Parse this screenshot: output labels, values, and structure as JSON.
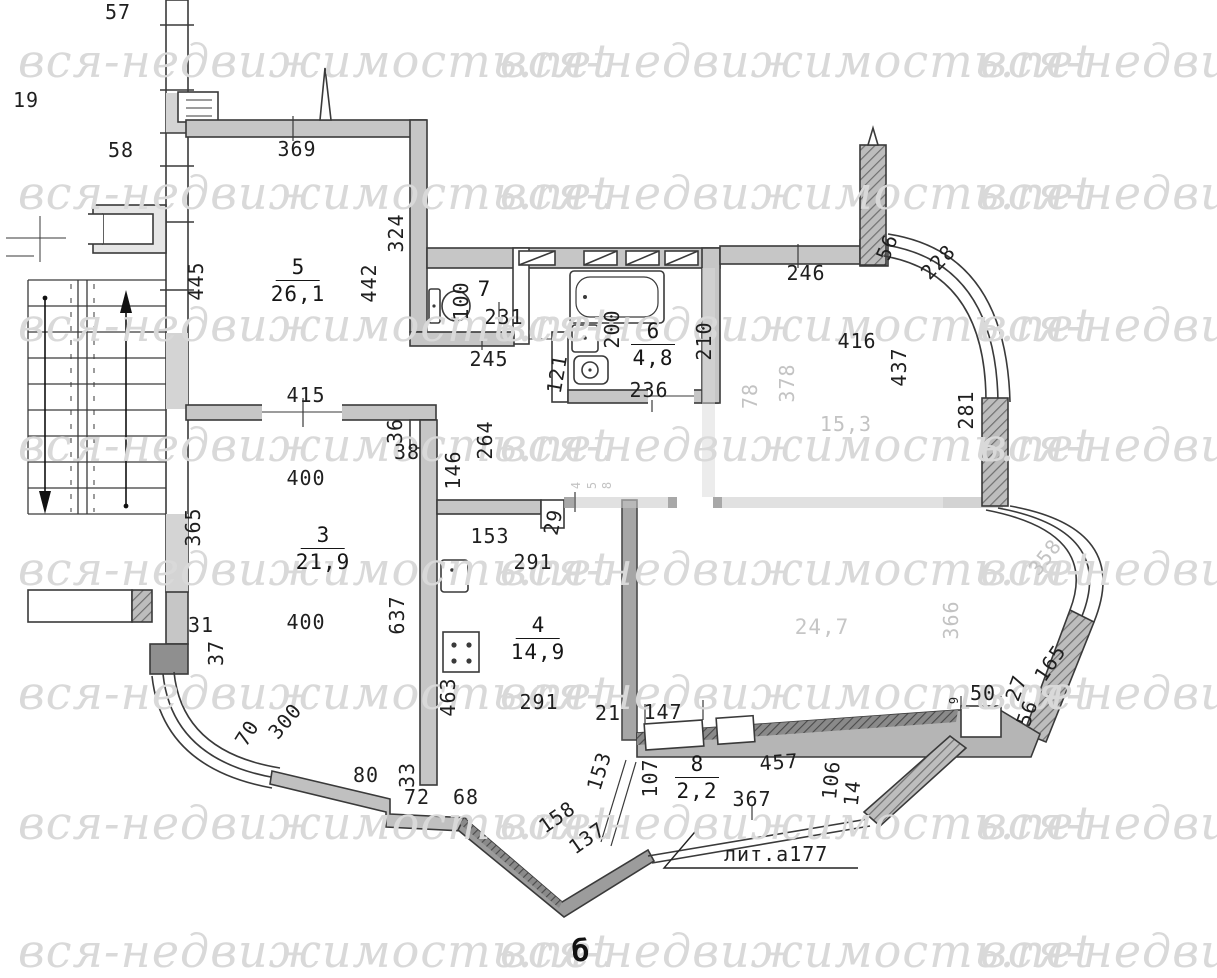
{
  "watermark": {
    "text": "вся-недвижимость.net",
    "color": "#d9d9d9"
  },
  "plan": {
    "litera": {
      "text": "лит.а177"
    },
    "rooms": [
      {
        "number": "5",
        "area": "26,1",
        "x": 298,
        "y": 256
      },
      {
        "number": "7",
        "area": "",
        "x": 484,
        "y": 278
      },
      {
        "number": "6",
        "area": "4,8",
        "x": 653,
        "y": 320
      },
      {
        "number": "3",
        "area": "21,9",
        "x": 323,
        "y": 524
      },
      {
        "number": "4",
        "area": "14,9",
        "x": 538,
        "y": 614
      },
      {
        "number": "8",
        "area": "2,2",
        "x": 697,
        "y": 753
      },
      {
        "number": "",
        "area": "24,7",
        "x": 822,
        "y": 616,
        "faded": true
      }
    ],
    "labels": [
      {
        "t": "57",
        "x": 118,
        "y": 12
      },
      {
        "t": "19",
        "x": 26,
        "y": 100
      },
      {
        "t": "58",
        "x": 121,
        "y": 150
      },
      {
        "t": "369",
        "x": 297,
        "y": 149
      },
      {
        "t": "445",
        "x": 196,
        "y": 281,
        "r": -90
      },
      {
        "t": "324",
        "x": 396,
        "y": 233,
        "r": -90
      },
      {
        "t": "442",
        "x": 369,
        "y": 283,
        "r": -90
      },
      {
        "t": "100",
        "x": 461,
        "y": 301,
        "r": -90
      },
      {
        "t": "231",
        "x": 504,
        "y": 317
      },
      {
        "t": "245",
        "x": 489,
        "y": 359
      },
      {
        "t": "121",
        "x": 557,
        "y": 374,
        "r": -80
      },
      {
        "t": "200",
        "x": 612,
        "y": 329,
        "r": -90
      },
      {
        "t": "236",
        "x": 649,
        "y": 390
      },
      {
        "t": "210",
        "x": 704,
        "y": 341,
        "r": -90
      },
      {
        "t": "246",
        "x": 806,
        "y": 273
      },
      {
        "t": "56",
        "x": 887,
        "y": 247,
        "r": -68
      },
      {
        "t": "228",
        "x": 938,
        "y": 262,
        "r": -46
      },
      {
        "t": "416",
        "x": 857,
        "y": 341
      },
      {
        "t": "437",
        "x": 899,
        "y": 367,
        "r": -90
      },
      {
        "t": "281",
        "x": 966,
        "y": 410,
        "r": -90
      },
      {
        "t": "78",
        "x": 750,
        "y": 396,
        "r": -90,
        "f": 1
      },
      {
        "t": "378",
        "x": 787,
        "y": 383,
        "r": -90,
        "f": 1
      },
      {
        "t": "15,3",
        "x": 846,
        "y": 424,
        "f": 1
      },
      {
        "t": "415",
        "x": 306,
        "y": 395
      },
      {
        "t": "36",
        "x": 395,
        "y": 431,
        "r": -90
      },
      {
        "t": "38",
        "x": 407,
        "y": 452
      },
      {
        "t": "146",
        "x": 453,
        "y": 470,
        "r": -90
      },
      {
        "t": "264",
        "x": 485,
        "y": 440,
        "r": -90
      },
      {
        "t": "400",
        "x": 306,
        "y": 478
      },
      {
        "t": "365",
        "x": 193,
        "y": 527,
        "r": -90
      },
      {
        "t": "400",
        "x": 306,
        "y": 622
      },
      {
        "t": "637",
        "x": 397,
        "y": 615,
        "r": -90
      },
      {
        "t": "153",
        "x": 490,
        "y": 536
      },
      {
        "t": "291",
        "x": 533,
        "y": 562
      },
      {
        "t": "29",
        "x": 553,
        "y": 522,
        "r": -78
      },
      {
        "t": "4",
        "x": 576,
        "y": 485,
        "r": -90,
        "f": 1,
        "s": 1
      },
      {
        "t": "5",
        "x": 592,
        "y": 485,
        "r": -90,
        "f": 1,
        "s": 1
      },
      {
        "t": "8",
        "x": 607,
        "y": 485,
        "r": -90,
        "f": 1,
        "s": 1
      },
      {
        "t": "463",
        "x": 448,
        "y": 697,
        "r": -90
      },
      {
        "t": "291",
        "x": 539,
        "y": 702
      },
      {
        "t": "31",
        "x": 201,
        "y": 625
      },
      {
        "t": "37",
        "x": 216,
        "y": 653,
        "r": -90
      },
      {
        "t": "70",
        "x": 247,
        "y": 733,
        "r": -58
      },
      {
        "t": "300",
        "x": 285,
        "y": 721,
        "r": -50
      },
      {
        "t": "80",
        "x": 366,
        "y": 775
      },
      {
        "t": "33",
        "x": 407,
        "y": 775,
        "r": -90
      },
      {
        "t": "72",
        "x": 417,
        "y": 797
      },
      {
        "t": "68",
        "x": 466,
        "y": 797
      },
      {
        "t": "158",
        "x": 557,
        "y": 817,
        "r": -35
      },
      {
        "t": "137",
        "x": 587,
        "y": 838,
        "r": -35
      },
      {
        "t": "153",
        "x": 599,
        "y": 771,
        "r": -73
      },
      {
        "t": "21",
        "x": 608,
        "y": 713
      },
      {
        "t": "147",
        "x": 663,
        "y": 712
      },
      {
        "t": "107",
        "x": 650,
        "y": 778,
        "r": -90
      },
      {
        "t": "457",
        "x": 779,
        "y": 762,
        "r": -4
      },
      {
        "t": "367",
        "x": 752,
        "y": 799
      },
      {
        "t": "106",
        "x": 831,
        "y": 780,
        "r": -84
      },
      {
        "t": "14",
        "x": 852,
        "y": 793,
        "r": -84
      },
      {
        "t": "9",
        "x": 954,
        "y": 700,
        "r": -90,
        "s": 1
      },
      {
        "t": "50",
        "x": 983,
        "y": 693
      },
      {
        "t": "27",
        "x": 1016,
        "y": 688,
        "r": -70
      },
      {
        "t": "56",
        "x": 1027,
        "y": 713,
        "r": -70
      },
      {
        "t": "165",
        "x": 1050,
        "y": 663,
        "r": -56
      },
      {
        "t": "366",
        "x": 951,
        "y": 620,
        "r": -90,
        "f": 1
      },
      {
        "t": "358",
        "x": 1045,
        "y": 557,
        "r": -52,
        "f": 1
      },
      {
        "t": "б",
        "x": 581,
        "y": 952,
        "b": 1,
        "n": "cropped-caption-glyph"
      }
    ]
  }
}
